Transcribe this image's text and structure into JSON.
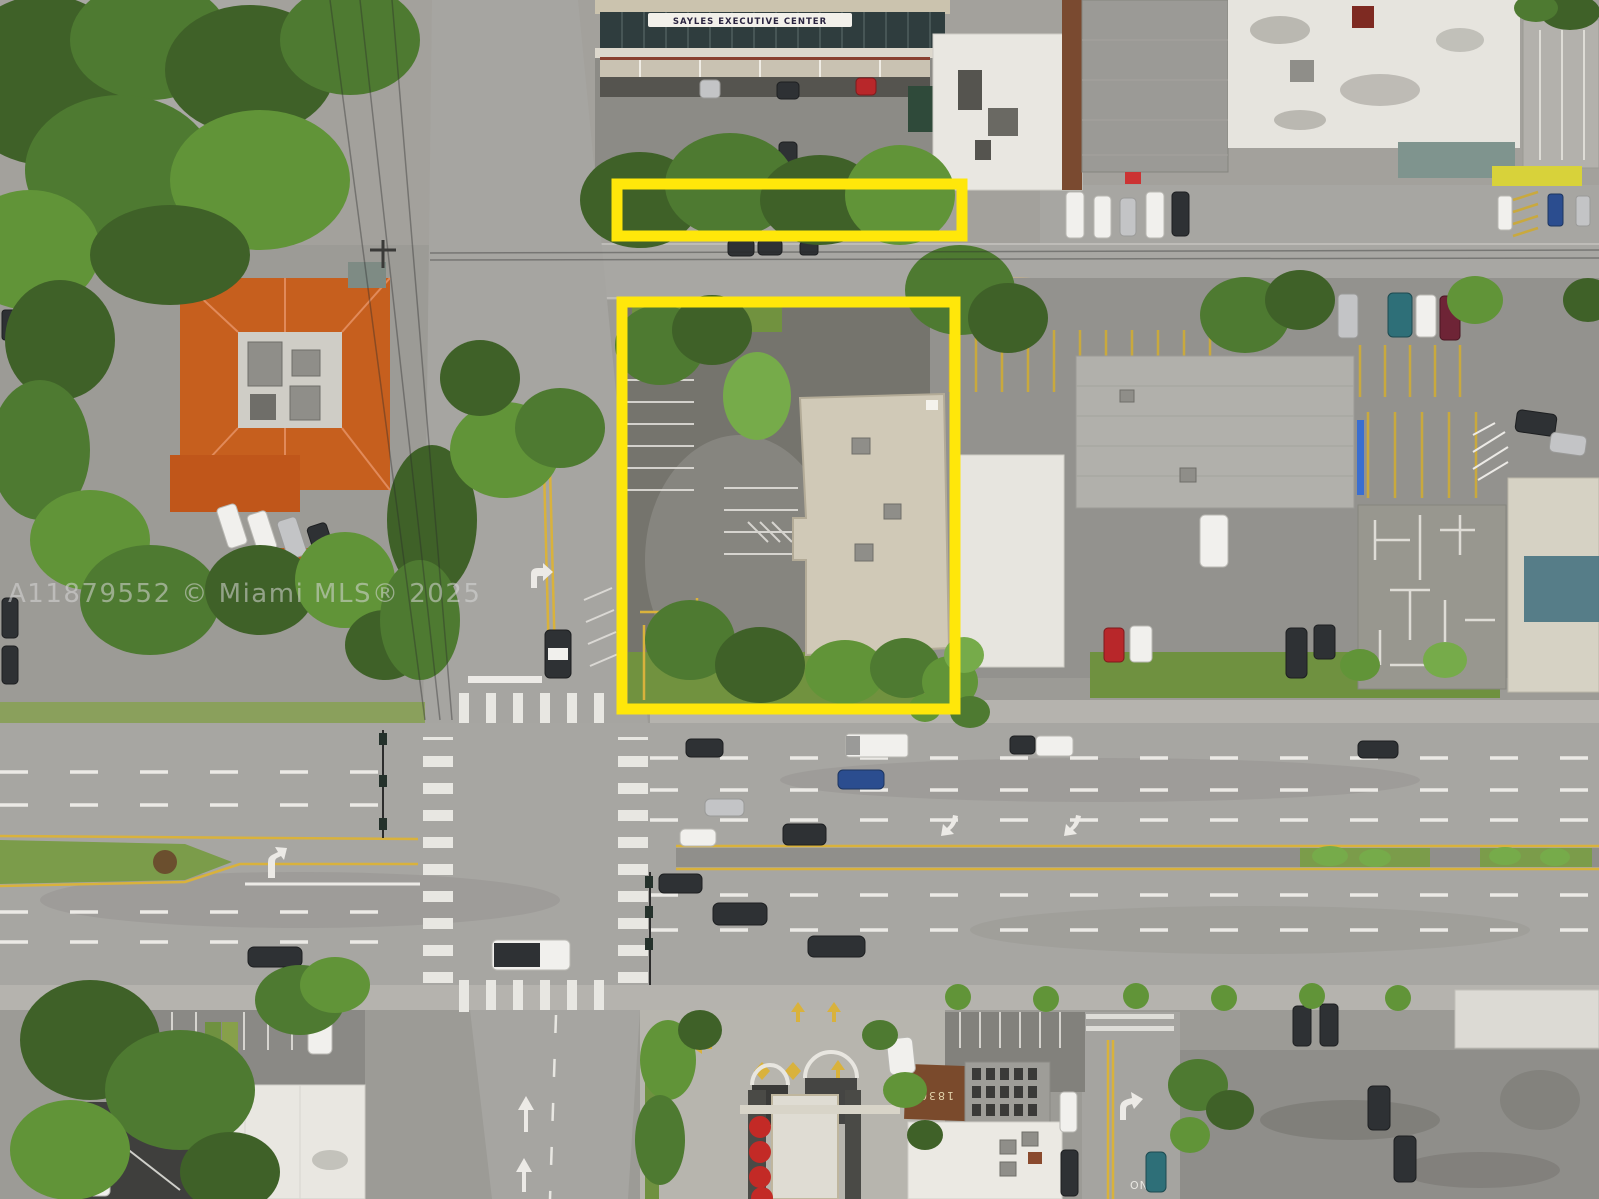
{
  "meta": {
    "title": "Aerial drone photo of commercial property listing",
    "description": "Top-down aerial view of a commercial block at a six-lane road intersection; two parcels outlined in yellow; orange tile-roof building at left, office and warehouse rooftops, parking lots, and a drive-thru canopy at bottom"
  },
  "watermark": {
    "text": "A11879552 © Miami MLS® 2025",
    "color": "#d8d8d8"
  },
  "signs": {
    "building_sign": "SAYLES EXECUTIVE CENTER",
    "roof_address": "1830",
    "pavement_only": "ONLY"
  },
  "annotations": {
    "outline_color": "#ffe70a",
    "boxes": [
      {
        "name": "secondary parcel strip outline",
        "shape": "horizontal rectangle"
      },
      {
        "name": "main parcel outline",
        "shape": "large rectangle around parking lot and flat-roof building"
      }
    ]
  },
  "palette": {
    "asphalt": "#9c9b96",
    "road": "#a7a6a2",
    "dark_lot": "#75746d",
    "sidewalk": "#b5b3ae",
    "tree_green": "#4e7a31",
    "grass_green": "#7b9c4a",
    "tile_orange": "#c65f1e",
    "roof_white": "#e8e6e0",
    "roof_beige": "#d0c9b7",
    "lane_white": "#eceae6",
    "lane_yellow": "#d9b23c",
    "umbrella_red": "#c32a26"
  }
}
